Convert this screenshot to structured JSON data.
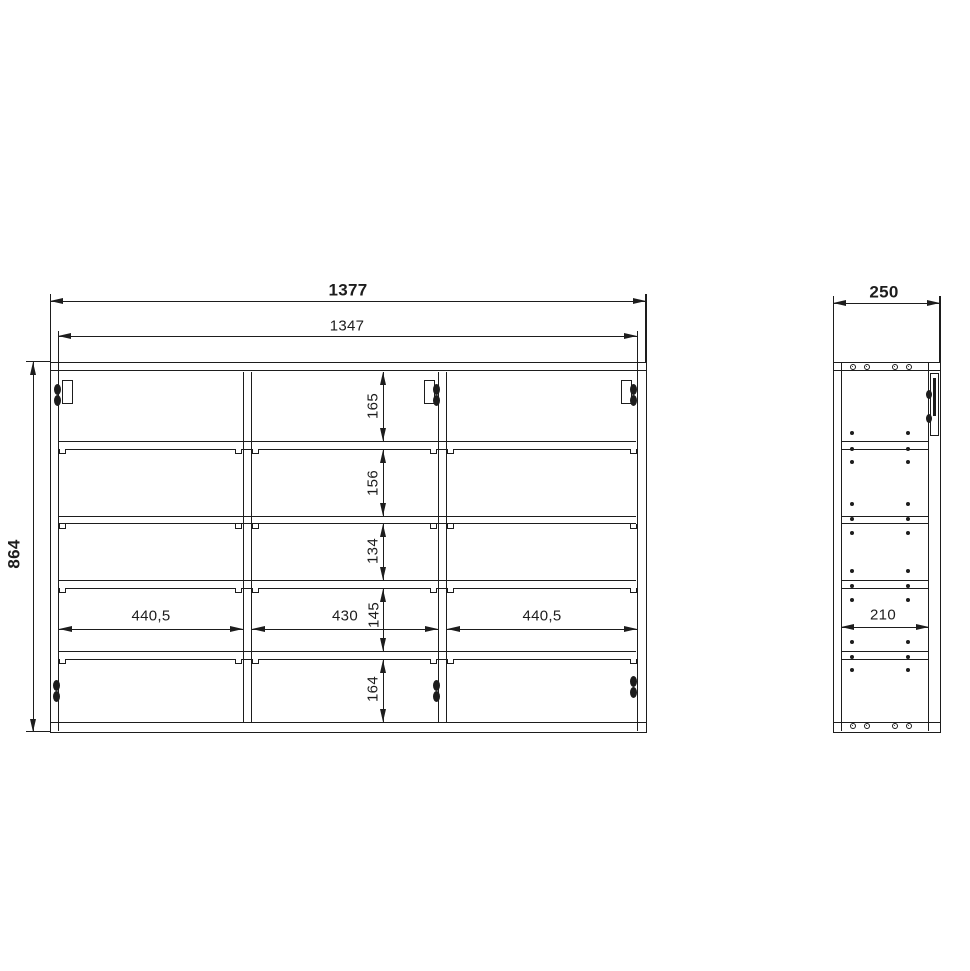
{
  "drawing_title": "wall-cabinet-dimension-drawing",
  "front_view": {
    "overall_width": "1377",
    "inner_width": "1347",
    "overall_height": "864",
    "row_heights": [
      "165",
      "156",
      "134",
      "145",
      "164"
    ],
    "column_widths": [
      "440,5",
      "430",
      "440,5"
    ]
  },
  "side_view": {
    "overall_depth": "250",
    "inner_depth": "210"
  },
  "colors": {
    "line": "#1d1d1d",
    "background": "#ffffff"
  }
}
